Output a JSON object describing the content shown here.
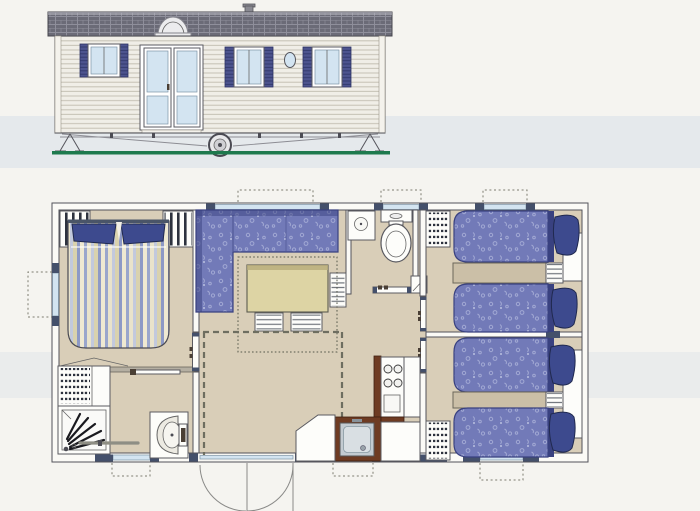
{
  "meta": {
    "description": "Scanned mobile-home brochure drawing: side elevation above, furnished floor plan below. No text is printed on the drawing."
  },
  "colors": {
    "paper": "#f5f4f0",
    "scanBand": "#cbd8e4",
    "floor": "#d9ceb8",
    "wallFill": "#fbfaf6",
    "wallStroke": "#52525a",
    "glass": "#d3e4f1",
    "frameDark": "#44506b",
    "sofa": "#727ab8",
    "sofaSpeckle": "#a9b0d8",
    "sofaEdge": "#394180",
    "pillow": "#3d4a8e",
    "nightstand": "#cbbfa7",
    "table": "#ddd4a4",
    "tableEdge": "#b8ab7a",
    "counter": "#6e3b22",
    "steel": "#c3cbd1",
    "duvet1": "#9aa6cc",
    "duvet2": "#e9e3cb",
    "duvet3": "#c2c9dd",
    "duvet4": "#d9d2ae",
    "duvet5": "#8d99c6",
    "duvet6": "#efe9d2",
    "roof": "#6b6b77",
    "roofLine": "#8f8f9b",
    "siding": "#f0eee7",
    "sidingLine": "#c5c1b4",
    "shutter": "#4d548f",
    "shutterLine": "#333a6e",
    "ground": "#1e7a4e",
    "dark": "#1a1a1f"
  },
  "elevation": {
    "features": [
      {
        "name": "tiled-roof"
      },
      {
        "name": "roof-dome-skylight"
      },
      {
        "name": "roof-vent"
      },
      {
        "name": "clapboard-siding"
      },
      {
        "name": "shuttered-window",
        "count": 3
      },
      {
        "name": "french-doors"
      },
      {
        "name": "porthole-window"
      },
      {
        "name": "chassis-wheel"
      },
      {
        "name": "corner-steadies",
        "count": 2
      },
      {
        "name": "ground-line"
      }
    ]
  },
  "floorplan": {
    "rooms": [
      {
        "name": "master-bedroom",
        "furniture": [
          "double-bed",
          "wardrobe",
          "wardrobe",
          "side-window"
        ]
      },
      {
        "name": "bathroom",
        "furniture": [
          "corner-shower",
          "shelved-storage-unit",
          "washbasin",
          "towel-rail",
          "window"
        ]
      },
      {
        "name": "living-dining",
        "furniture": [
          "corner-sofa",
          "dining-table",
          "bench-seat",
          "bench-seat",
          "slatted-shelf",
          "window",
          "entrance-french-doors"
        ]
      },
      {
        "name": "wc",
        "furniture": [
          "toilet",
          "corner-washbasin",
          "window"
        ]
      },
      {
        "name": "kitchen",
        "furniture": [
          "four-burner-hob",
          "sink",
          "angled-worktop",
          "base-cabinets",
          "window"
        ]
      },
      {
        "name": "hallway",
        "furniture": [
          "bedroom-door",
          "bedroom-door",
          "shelved-wardrobe",
          "shelved-wardrobe"
        ]
      },
      {
        "name": "twin-bedroom-front",
        "furniture": [
          "single-bed",
          "single-bed",
          "bedside-shelf",
          "headboard-panel",
          "window"
        ]
      },
      {
        "name": "twin-bedroom-rear",
        "furniture": [
          "single-bed",
          "single-bed",
          "bedside-shelf",
          "headboard-panel",
          "window"
        ]
      }
    ],
    "window_count": 7,
    "exterior_door_count": 1
  }
}
